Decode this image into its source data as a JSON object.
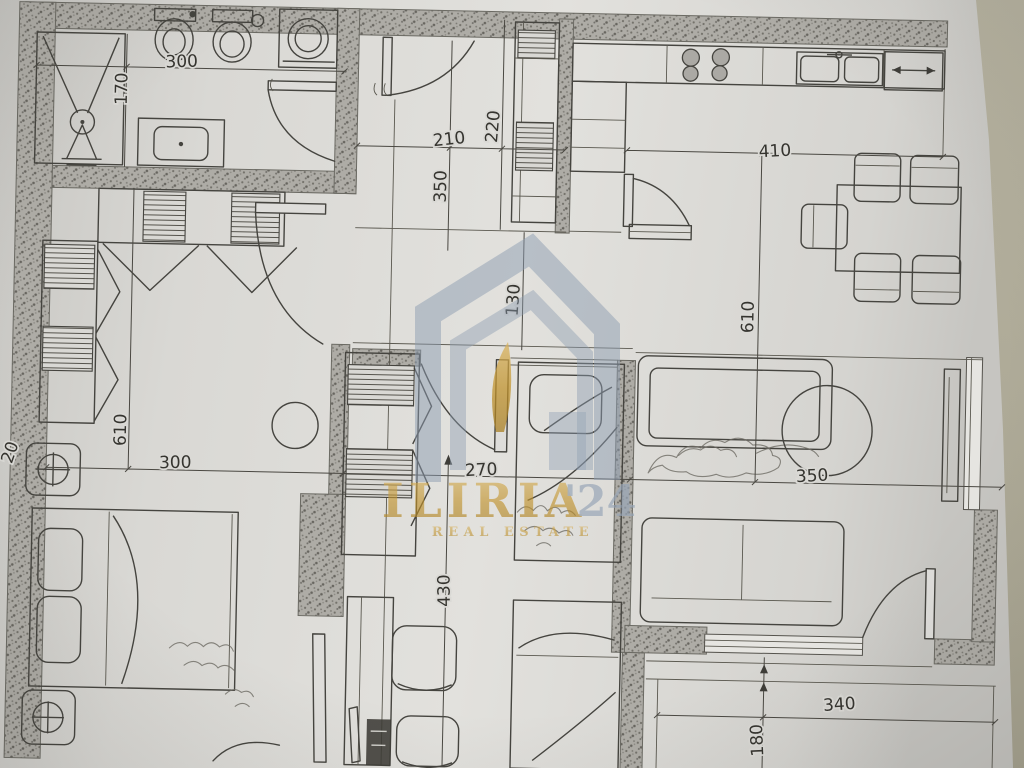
{
  "document": {
    "type": "apartment floor plan photo",
    "background_color": "#b2ae9c",
    "paper_color": "#deddda",
    "ink_color": "#45443f",
    "wall_fill": "#aaa8a3"
  },
  "watermark": {
    "brand": "ILIRIA",
    "brand_suffix": "'24",
    "tagline": "REAL ESTATE",
    "gold_color": "#c2942e",
    "slate_color": "#8c9cb1"
  },
  "dimensions": [
    {
      "label": "300",
      "area": "bathroom-width"
    },
    {
      "label": "170",
      "area": "bathroom-depth"
    },
    {
      "label": "210",
      "area": "entry-hall-width"
    },
    {
      "label": "220",
      "area": "entry-hall-depth"
    },
    {
      "label": "350",
      "area": "hall-length"
    },
    {
      "label": "410",
      "area": "kitchen-width"
    },
    {
      "label": "130",
      "area": "corridor-length"
    },
    {
      "label": "610",
      "area": "living-dining-length"
    },
    {
      "label": "610",
      "area": "bedroom-length"
    },
    {
      "label": "300",
      "area": "bedroom-width"
    },
    {
      "label": "20",
      "area": "wall-thickness"
    },
    {
      "label": "270",
      "area": "kids-room-width"
    },
    {
      "label": "350",
      "area": "living-room-width"
    },
    {
      "label": "430",
      "area": "kids-room-length"
    },
    {
      "label": "340",
      "area": "balcony-width"
    },
    {
      "label": "180",
      "area": "balcony-depth"
    }
  ]
}
